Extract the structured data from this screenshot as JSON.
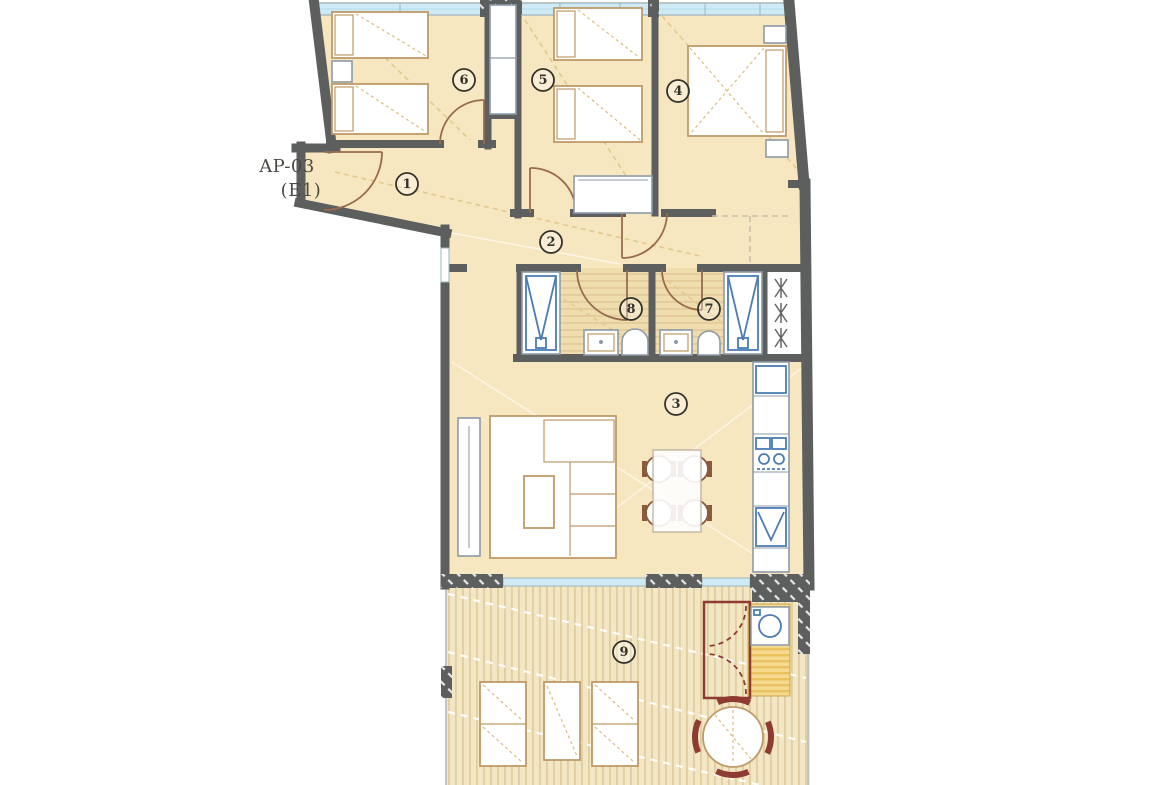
{
  "label": {
    "line1": "AP-03",
    "line2": "(E1)"
  },
  "rooms": [
    {
      "number": "1"
    },
    {
      "number": "2"
    },
    {
      "number": "3"
    },
    {
      "number": "4"
    },
    {
      "number": "5"
    },
    {
      "number": "6"
    },
    {
      "number": "7"
    },
    {
      "number": "8"
    },
    {
      "number": "9"
    }
  ],
  "colors": {
    "background": "#ffffff",
    "wall": "#5d5e5e",
    "floor": "#f7e7c0",
    "window_glass": "#cdeaf5",
    "window_frame": "#9eb4bc",
    "furniture_fill": "#ffffff",
    "furniture_outline": "#bf9a68",
    "door_arc": "#996b4e",
    "fixture_blue": "#4d7cb5",
    "fixture_gray": "#8d9aa8",
    "closet_maroon": "#8d3b33",
    "terrace_base": "#f2e6c5",
    "terrace_stripe": "#e0cda0",
    "bath_base": "#f0ddae",
    "bath_stripe": "#e3cc9a",
    "closet_stripe_a": "#f5d98f",
    "closet_stripe_b": "#eac25f",
    "dashed_ceiling": "#e4c98f",
    "dashed_white": "#ffffff",
    "beam_dash": "#c9c0a8",
    "label_text": "#4b4a43",
    "number_text": "#35322a"
  }
}
